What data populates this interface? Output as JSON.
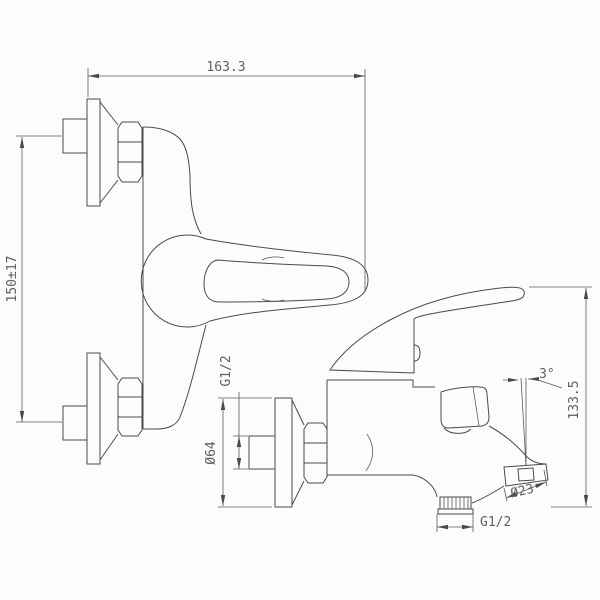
{
  "drawing": {
    "subject": "Wall-mounted single-lever bath mixer tap, dimensioned front and side views",
    "background_color": "#fcfcfc",
    "line_color": "#4a4a4a",
    "text_color": "#5f5f5f",
    "dimensions": {
      "overall_width": "163.3",
      "wall_mount_spacing": "150±17",
      "wall_inlet_thread": "G1/2",
      "escutcheon_diameter": "Ø64",
      "spout_angle": "3°",
      "overall_height": "133.5",
      "spout_outlet_diameter": "Ø23",
      "shower_outlet_thread": "G1/2"
    }
  }
}
